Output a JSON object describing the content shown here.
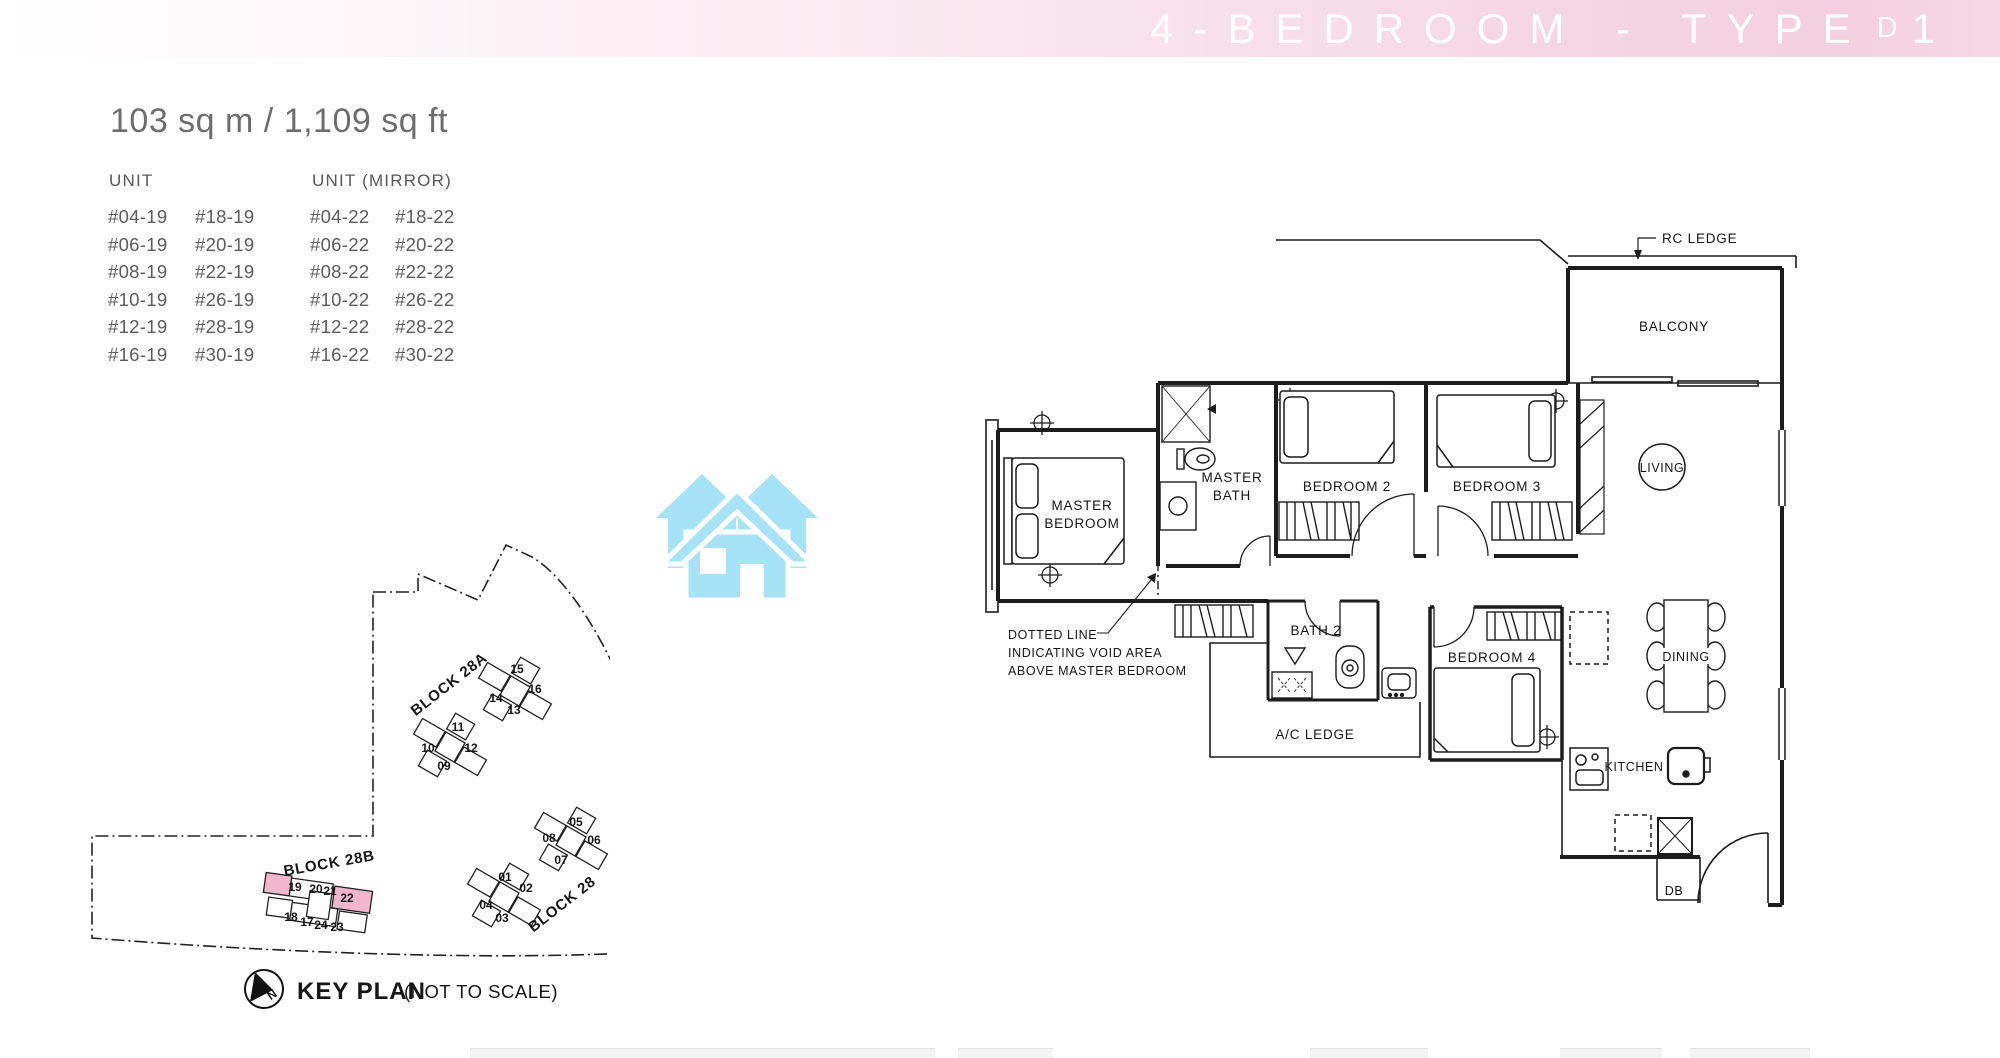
{
  "header": {
    "title": "4-BEDROOM - TYPE",
    "type_letter": "D",
    "type_digit": "1"
  },
  "summary": {
    "area": "103 sq m / 1,109 sq ft"
  },
  "unit_table": {
    "col1_header": "UNIT",
    "col2_header": "UNIT (MIRROR)",
    "rows": [
      [
        "#04-19",
        "#18-19",
        "#04-22",
        "#18-22"
      ],
      [
        "#06-19",
        "#20-19",
        "#06-22",
        "#20-22"
      ],
      [
        "#08-19",
        "#22-19",
        "#08-22",
        "#22-22"
      ],
      [
        "#10-19",
        "#26-19",
        "#10-22",
        "#26-22"
      ],
      [
        "#12-19",
        "#28-19",
        "#12-22",
        "#28-22"
      ],
      [
        "#16-19",
        "#30-19",
        "#16-22",
        "#30-22"
      ]
    ]
  },
  "key_plan": {
    "title": "KEY PLAN",
    "subtitle": "(NOT TO SCALE)",
    "north": "N",
    "block_a_label": "BLOCK 28A",
    "block_b_label": "BLOCK 28B",
    "block_label": "BLOCK 28",
    "highlight_color": "#f2b7cd",
    "highlighted_units": [
      "19",
      "22"
    ],
    "clusters": [
      {
        "units": [
          "11",
          "10",
          "12",
          "09"
        ]
      },
      {
        "units": [
          "15",
          "14",
          "16",
          "13"
        ]
      },
      {
        "units": [
          "05",
          "08",
          "06",
          "07"
        ]
      },
      {
        "units": [
          "01",
          "04",
          "02",
          "03"
        ]
      },
      {
        "units": [
          "19",
          "20",
          "21",
          "22",
          "18",
          "17",
          "24",
          "23"
        ]
      }
    ]
  },
  "floor_plan": {
    "rc_ledge": "RC LEDGE",
    "balcony": "BALCONY",
    "living": "LIVING",
    "dining": "DINING",
    "kitchen": "KITCHEN",
    "db": "DB",
    "master_bedroom_l1": "MASTER",
    "master_bedroom_l2": "BEDROOM",
    "master_bath_l1": "MASTER",
    "master_bath_l2": "BATH",
    "bedroom2": "BEDROOM 2",
    "bedroom3": "BEDROOM 3",
    "bedroom4": "BEDROOM 4",
    "bath2": "BATH 2",
    "ac_ledge": "A/C LEDGE",
    "void_l1": "DOTTED LINE",
    "void_l2": "INDICATING VOID AREA",
    "void_l3": "ABOVE MASTER BEDROOM"
  }
}
